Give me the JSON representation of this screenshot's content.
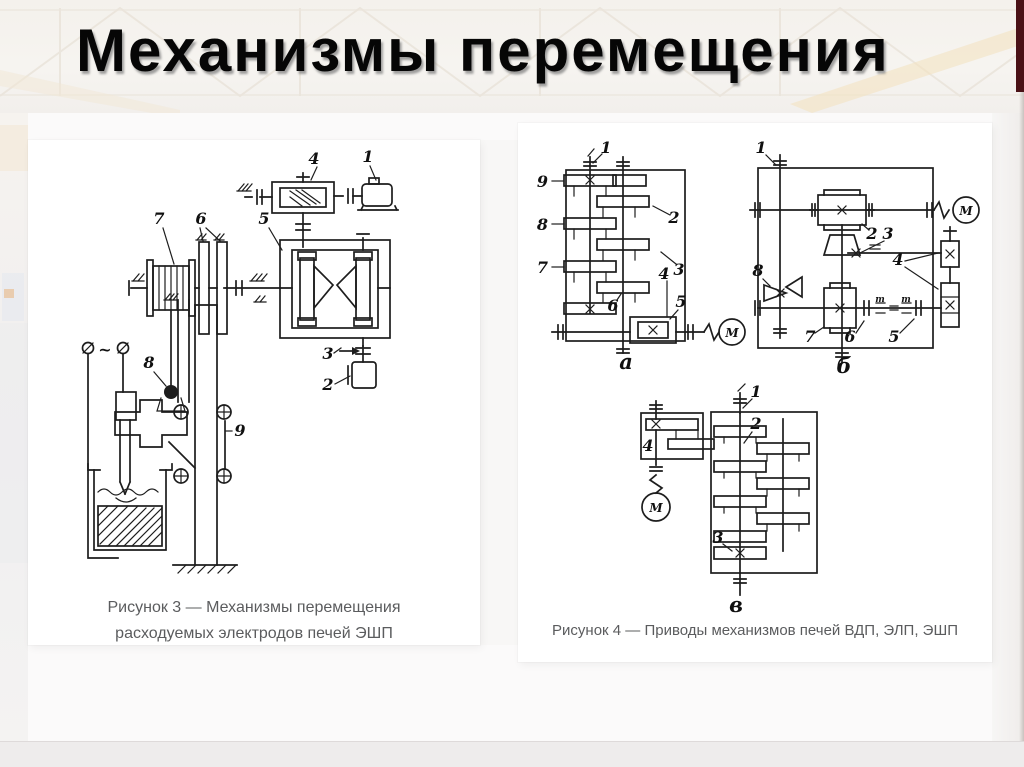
{
  "slide": {
    "title": "Механизмы перемещения"
  },
  "colors": {
    "accent_stripe": "#4a1116",
    "drawing_ink": "#1d1d1d",
    "caption_text": "#5b5c5e"
  },
  "figure3": {
    "caption_line1": "Рисунок 3 — Механизмы перемещения",
    "caption_line2": "расходуемых электродов печей ЭШП",
    "labels": {
      "n1": "1",
      "n2": "2",
      "n3": "3",
      "n4": "4",
      "n5": "5",
      "n6": "6",
      "n7": "7",
      "n8": "8",
      "n9": "9",
      "ac": "~"
    }
  },
  "figure4": {
    "caption": "Рисунок 4 — Приводы механизмов печей ВДП, ЭЛП, ЭШП",
    "a": {
      "label": "а",
      "motor": "М",
      "n1": "1",
      "n2": "2",
      "n3": "3",
      "n4": "4",
      "n5": "5",
      "n6": "6",
      "n7": "7",
      "n8": "8",
      "n9": "9"
    },
    "b": {
      "label": "б",
      "motor": "М",
      "screw": "m",
      "n1": "1",
      "n2": "2",
      "n3": "3",
      "n4": "4",
      "n5": "5",
      "n6": "6",
      "n7": "7",
      "n8": "8"
    },
    "v": {
      "label": "в",
      "motor": "М",
      "n1": "1",
      "n2": "2",
      "n3": "3",
      "n4": "4"
    }
  }
}
